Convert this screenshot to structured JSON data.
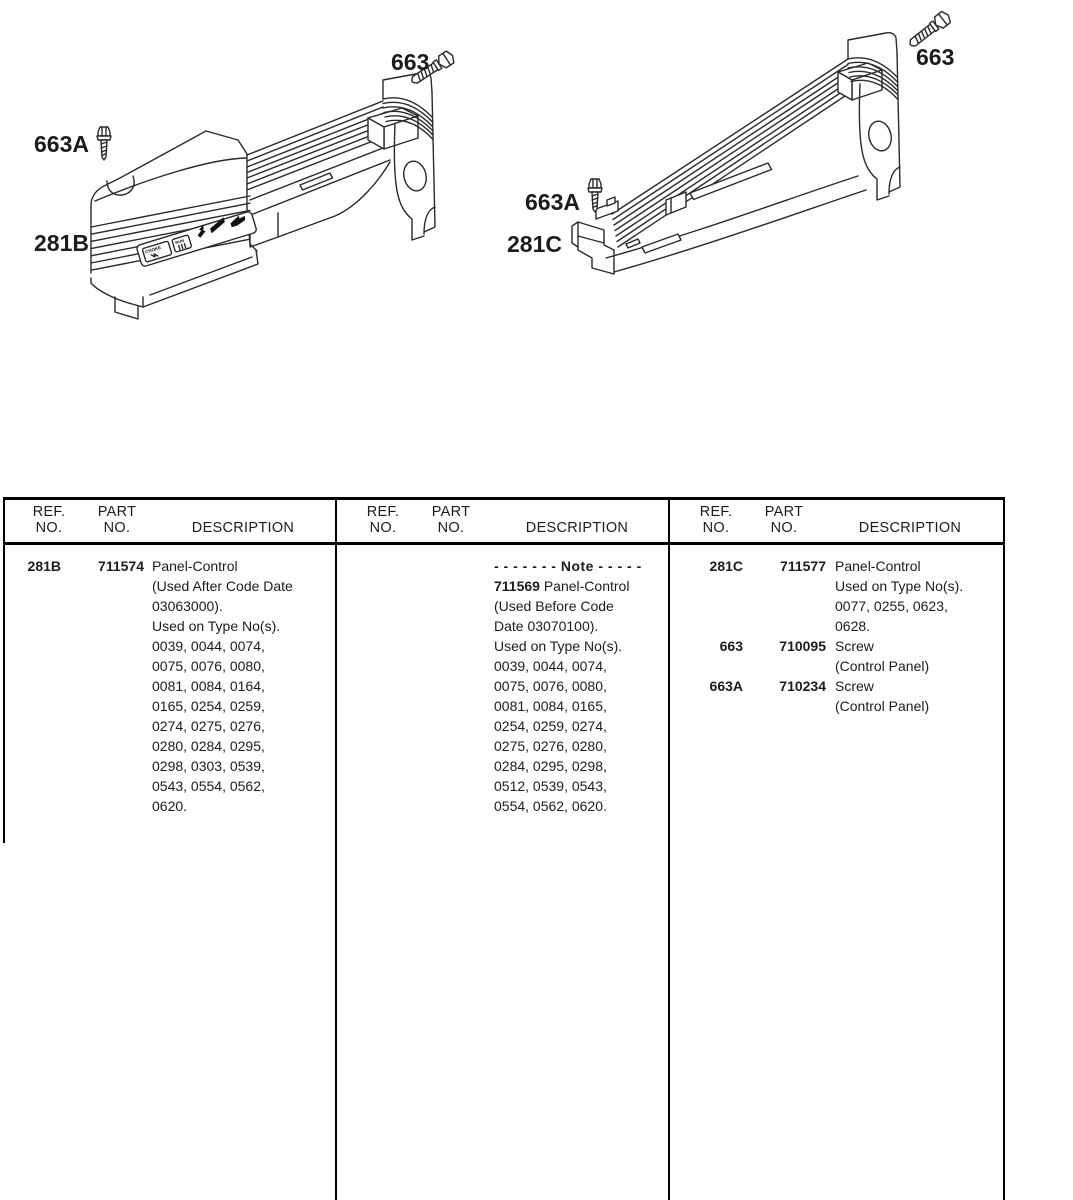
{
  "page": {
    "ink": "#1c1c1c",
    "rule_color": "#000000",
    "background": "#ffffff"
  },
  "diagrams": {
    "left": {
      "part_label": "281B",
      "bolt_label": "663",
      "screw_label": "663A",
      "cover": {
        "choke": "CHOKE",
        "run": "RUN"
      }
    },
    "right": {
      "part_label": "281C",
      "bolt_label": "663",
      "screw_label": "663A"
    }
  },
  "parts_table": {
    "columns": {
      "ref_line1": "REF.",
      "ref_line2": "NO.",
      "part_line1": "PART",
      "part_line2": "NO.",
      "description": "DESCRIPTION"
    },
    "section1": {
      "entry": {
        "ref": "281B",
        "part": "711574",
        "description_lines": [
          "Panel-Control",
          "(Used After Code Date",
          "03063000).",
          "Used on Type No(s).",
          "0039, 0044, 0074,",
          "0075, 0076, 0080,",
          "0081, 0084, 0164,",
          "0165, 0254, 0259,",
          "0274, 0275, 0276,",
          "0280, 0284, 0295,",
          "0298, 0303, 0539,",
          "0543, 0554, 0562,",
          "0620."
        ]
      }
    },
    "section2": {
      "note": {
        "title": "- - - - - - -  Note  - - - - -",
        "part": "711569",
        "first_line_rest": " Panel-Control",
        "description_lines": [
          "(Used Before Code",
          "Date 03070100).",
          "Used on Type No(s).",
          "0039, 0044, 0074,",
          "0075, 0076, 0080,",
          "0081, 0084, 0165,",
          "0254, 0259, 0274,",
          "0275, 0276, 0280,",
          "0284, 0295, 0298,",
          "0512, 0539, 0543,",
          "0554, 0562, 0620."
        ]
      }
    },
    "section3": {
      "entries": [
        {
          "ref": "281C",
          "part": "711577",
          "description_lines": [
            "Panel-Control",
            "Used on Type No(s).",
            "0077, 0255, 0623,",
            "0628."
          ]
        },
        {
          "ref": "663",
          "part": "710095",
          "description_lines": [
            "Screw",
            "(Control Panel)"
          ]
        },
        {
          "ref": "663A",
          "part": "710234",
          "description_lines": [
            "Screw",
            "(Control Panel)"
          ]
        }
      ]
    }
  }
}
